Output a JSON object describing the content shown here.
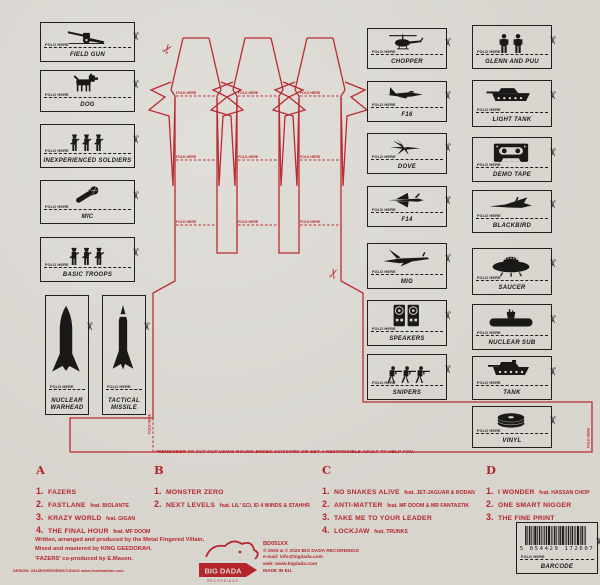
{
  "palette": {
    "background": "#d8d5cf",
    "print_red": "#b5262c",
    "print_black": "#1a1918"
  },
  "fold_label": "FOLD HERE",
  "cut_note": "*REMEMBER TO CUT OUT USING ROUND-ENDED SCISSORS OR GET A RESPONSIBLE ADULT TO HELP YOU.",
  "cutouts": {
    "left_column": [
      {
        "label": "FIELD GUN",
        "icon": "field-gun-icon"
      },
      {
        "label": "DOG",
        "icon": "dog-icon"
      },
      {
        "label": "INEXPERIENCED SOLDIERS",
        "icon": "soldiers-icon"
      },
      {
        "label": "MIC",
        "icon": "mic-icon"
      },
      {
        "label": "BASIC TROOPS",
        "icon": "troops-icon"
      }
    ],
    "left_tall": [
      {
        "label": "NUCLEAR WARHEAD",
        "icon": "warhead-icon"
      },
      {
        "label": "TACTICAL MISSILE",
        "icon": "missile-icon"
      }
    ],
    "mid_column": [
      {
        "label": "CHOPPER",
        "icon": "chopper-icon"
      },
      {
        "label": "F16",
        "icon": "f16-icon"
      },
      {
        "label": "DOVE",
        "icon": "dove-icon"
      },
      {
        "label": "F14",
        "icon": "f14-icon"
      },
      {
        "label": "MIG",
        "icon": "mig-icon"
      },
      {
        "label": "SPEAKERS",
        "icon": "speakers-icon"
      },
      {
        "label": "SNIPERS",
        "icon": "snipers-icon"
      }
    ],
    "right_column": [
      {
        "label": "GLENN AND PUU",
        "icon": "glenn-puu-icon"
      },
      {
        "label": "LIGHT TANK",
        "icon": "light-tank-icon"
      },
      {
        "label": "DEMO TAPE",
        "icon": "demo-tape-icon"
      },
      {
        "label": "BLACKBIRD",
        "icon": "blackbird-icon"
      },
      {
        "label": "SAUCER",
        "icon": "saucer-icon"
      },
      {
        "label": "NUCLEAR SUB",
        "icon": "nuclear-sub-icon"
      },
      {
        "label": "TANK",
        "icon": "tank-icon"
      },
      {
        "label": "VINYL",
        "icon": "vinyl-icon"
      }
    ],
    "barcode_box": {
      "label": "BARCODE",
      "icon": "barcode-icon",
      "number": "5 054429 172607"
    }
  },
  "tracklist": {
    "sections": [
      {
        "side": "A",
        "tracks": [
          {
            "num": "1.",
            "title": "FAZERS",
            "feat": ""
          },
          {
            "num": "2.",
            "title": "FASTLANE",
            "feat": "feat. BIOLANTE"
          },
          {
            "num": "3.",
            "title": "KRAZY WORLD",
            "feat": "feat. GIGAN"
          },
          {
            "num": "4.",
            "title": "THE FINAL HOUR",
            "feat": "feat. MF DOOM"
          }
        ]
      },
      {
        "side": "B",
        "tracks": [
          {
            "num": "1.",
            "title": "MONSTER ZERO",
            "feat": ""
          },
          {
            "num": "2.",
            "title": "NEXT LEVELS",
            "feat": "feat. LIL' SCI, ID 4 WINDS & STAHHR"
          }
        ]
      },
      {
        "side": "C",
        "tracks": [
          {
            "num": "1.",
            "title": "NO SNAKES ALIVE",
            "feat": "feat. JET-JAGUAR & RODAN"
          },
          {
            "num": "2.",
            "title": "ANTI-MATTER",
            "feat": "feat. MF DOOM & MR FANTASTIK"
          },
          {
            "num": "3.",
            "title": "TAKE ME TO YOUR LEADER",
            "feat": ""
          },
          {
            "num": "4.",
            "title": "LOCKJAW",
            "feat": "feat. TRUNKS"
          }
        ]
      },
      {
        "side": "D",
        "tracks": [
          {
            "num": "1.",
            "title": "I WONDER",
            "feat": "feat. HASSAN CHOP"
          },
          {
            "num": "2.",
            "title": "ONE SMART NIGGER",
            "feat": ""
          },
          {
            "num": "3.",
            "title": "THE FINE PRINT",
            "feat": ""
          }
        ]
      }
    ]
  },
  "credits": {
    "line1": "Written, arranged and produced by the Metal Fingered Villain.",
    "line2": "Mixed and mastered by KING GEEDORAH.",
    "line3": "'FAZERS' co-produced by E.Mason.",
    "design_line": "DESIGN: 2513RIVERVIEWSTUDIOS www.fivedeadline.com"
  },
  "label_info": {
    "catalog": "BD051XX",
    "copyright": "℗ 2003 & © 2023 BIG DADA RECORDINGS",
    "email": "e-mail: info@bigdada.com",
    "web": "web: www.bigdada.com",
    "made_in": "MADE IN EU.",
    "logo_text": "BIG DADA",
    "logo_sub": "RECORDINGS"
  }
}
